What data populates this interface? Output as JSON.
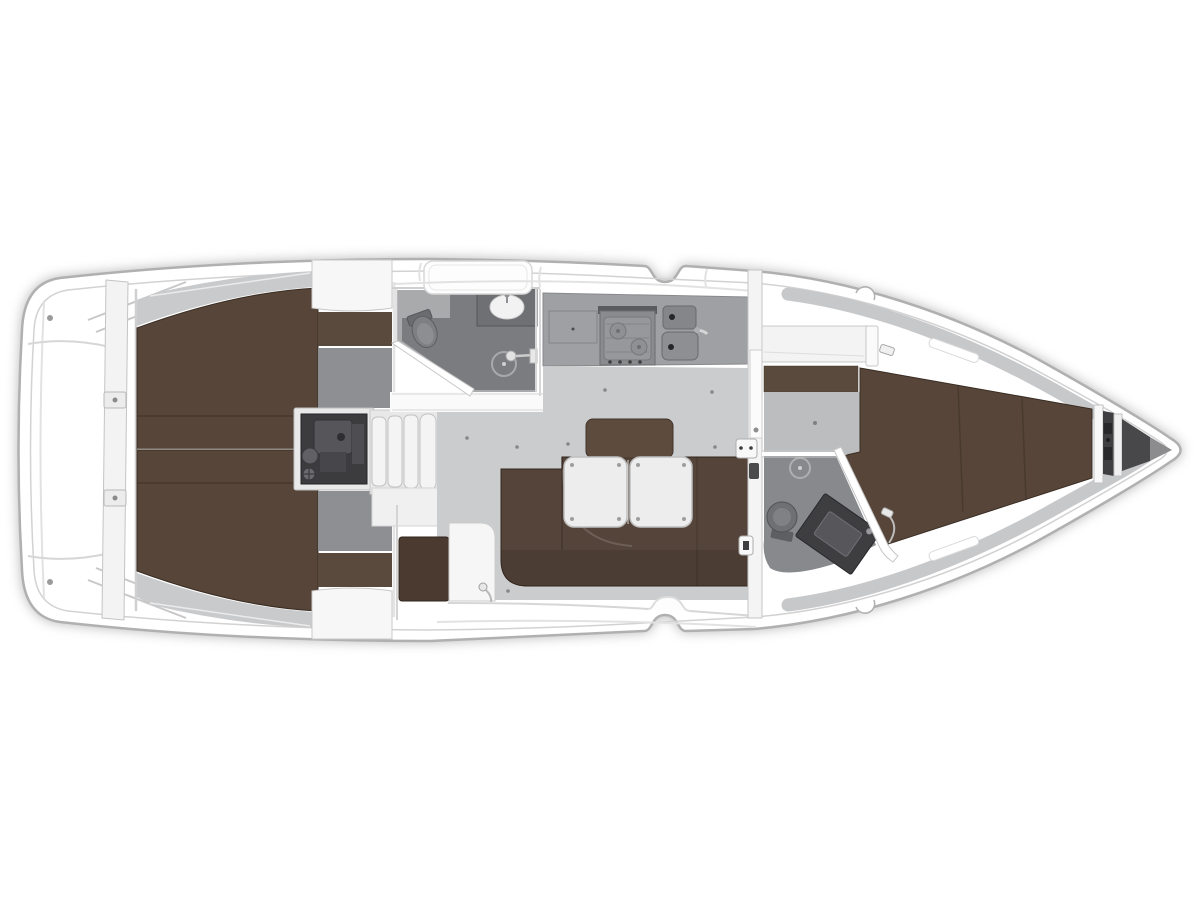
{
  "diagram": {
    "type": "sailing-yacht-interior-floor-plan",
    "orientation": "bow-right-stern-left",
    "areas": [
      {
        "name": "swim-platform-transom",
        "fixtures": [
          "transom-steps",
          "stern-cleats",
          "lazarette"
        ]
      },
      {
        "name": "aft-cabin-port",
        "fixtures": [
          "double-berth",
          "wardrobe",
          "dressing-floor"
        ]
      },
      {
        "name": "aft-cabin-starboard",
        "fixtures": [
          "double-berth",
          "wardrobe",
          "dressing-floor"
        ]
      },
      {
        "name": "engine-compartment",
        "fixtures": [
          "engine"
        ]
      },
      {
        "name": "companionway",
        "fixtures": [
          "four-steps"
        ]
      },
      {
        "name": "aft-head",
        "fixtures": [
          "toilet",
          "washbasin",
          "shower",
          "sliding-door"
        ]
      },
      {
        "name": "galley",
        "fixtures": [
          "two-burner-stove",
          "double-sink",
          "faucet",
          "locker"
        ]
      },
      {
        "name": "salon",
        "fixtures": [
          "u-shaped-settee",
          "two-folding-tables",
          "nav-seat",
          "partition"
        ]
      },
      {
        "name": "forward-cabin",
        "fixtures": [
          "v-berth",
          "shelf",
          "wardrobe"
        ]
      },
      {
        "name": "forward-head",
        "fixtures": [
          "toilet",
          "vanity-washbasin",
          "shower-drain"
        ]
      },
      {
        "name": "anchor-locker",
        "fixtures": [
          "windlass",
          "chain-compartment"
        ]
      }
    ]
  },
  "colors": {
    "background": "#ffffff",
    "hull_fill": "#ffffff",
    "hull_stroke": "#b0b0b0",
    "deck_line": "#d2d2d2",
    "coachroof_gray": "#c9cacc",
    "inner_hull_gray": "#c7c8ca",
    "berth_brown": "#564538",
    "settee_brown": "#55443a",
    "backrest_brown": "#5d4b3e",
    "seat_brown": "#4a3a2f",
    "wardrobe_brown": "#5a4a3d",
    "table_white": "#ededed",
    "panel_white": "#f4f4f4",
    "floor_gray": "#cbcccd",
    "dresser_floor_gray": "#8e8f92",
    "fwd_floor_gray": "#bcbdbf",
    "head_floor_gray": "#a9aaac",
    "shower_gray": "#7b7c7f",
    "fwd_head_floor": "#88898d",
    "counter_gray": "#9fa0a3",
    "appliance_gray": "#8a8b8e",
    "sink_gray": "#85868a",
    "engine_dark": "#3c3c3e",
    "anchor_dark": "#48484a",
    "fixture_dark": "#6f7073"
  }
}
